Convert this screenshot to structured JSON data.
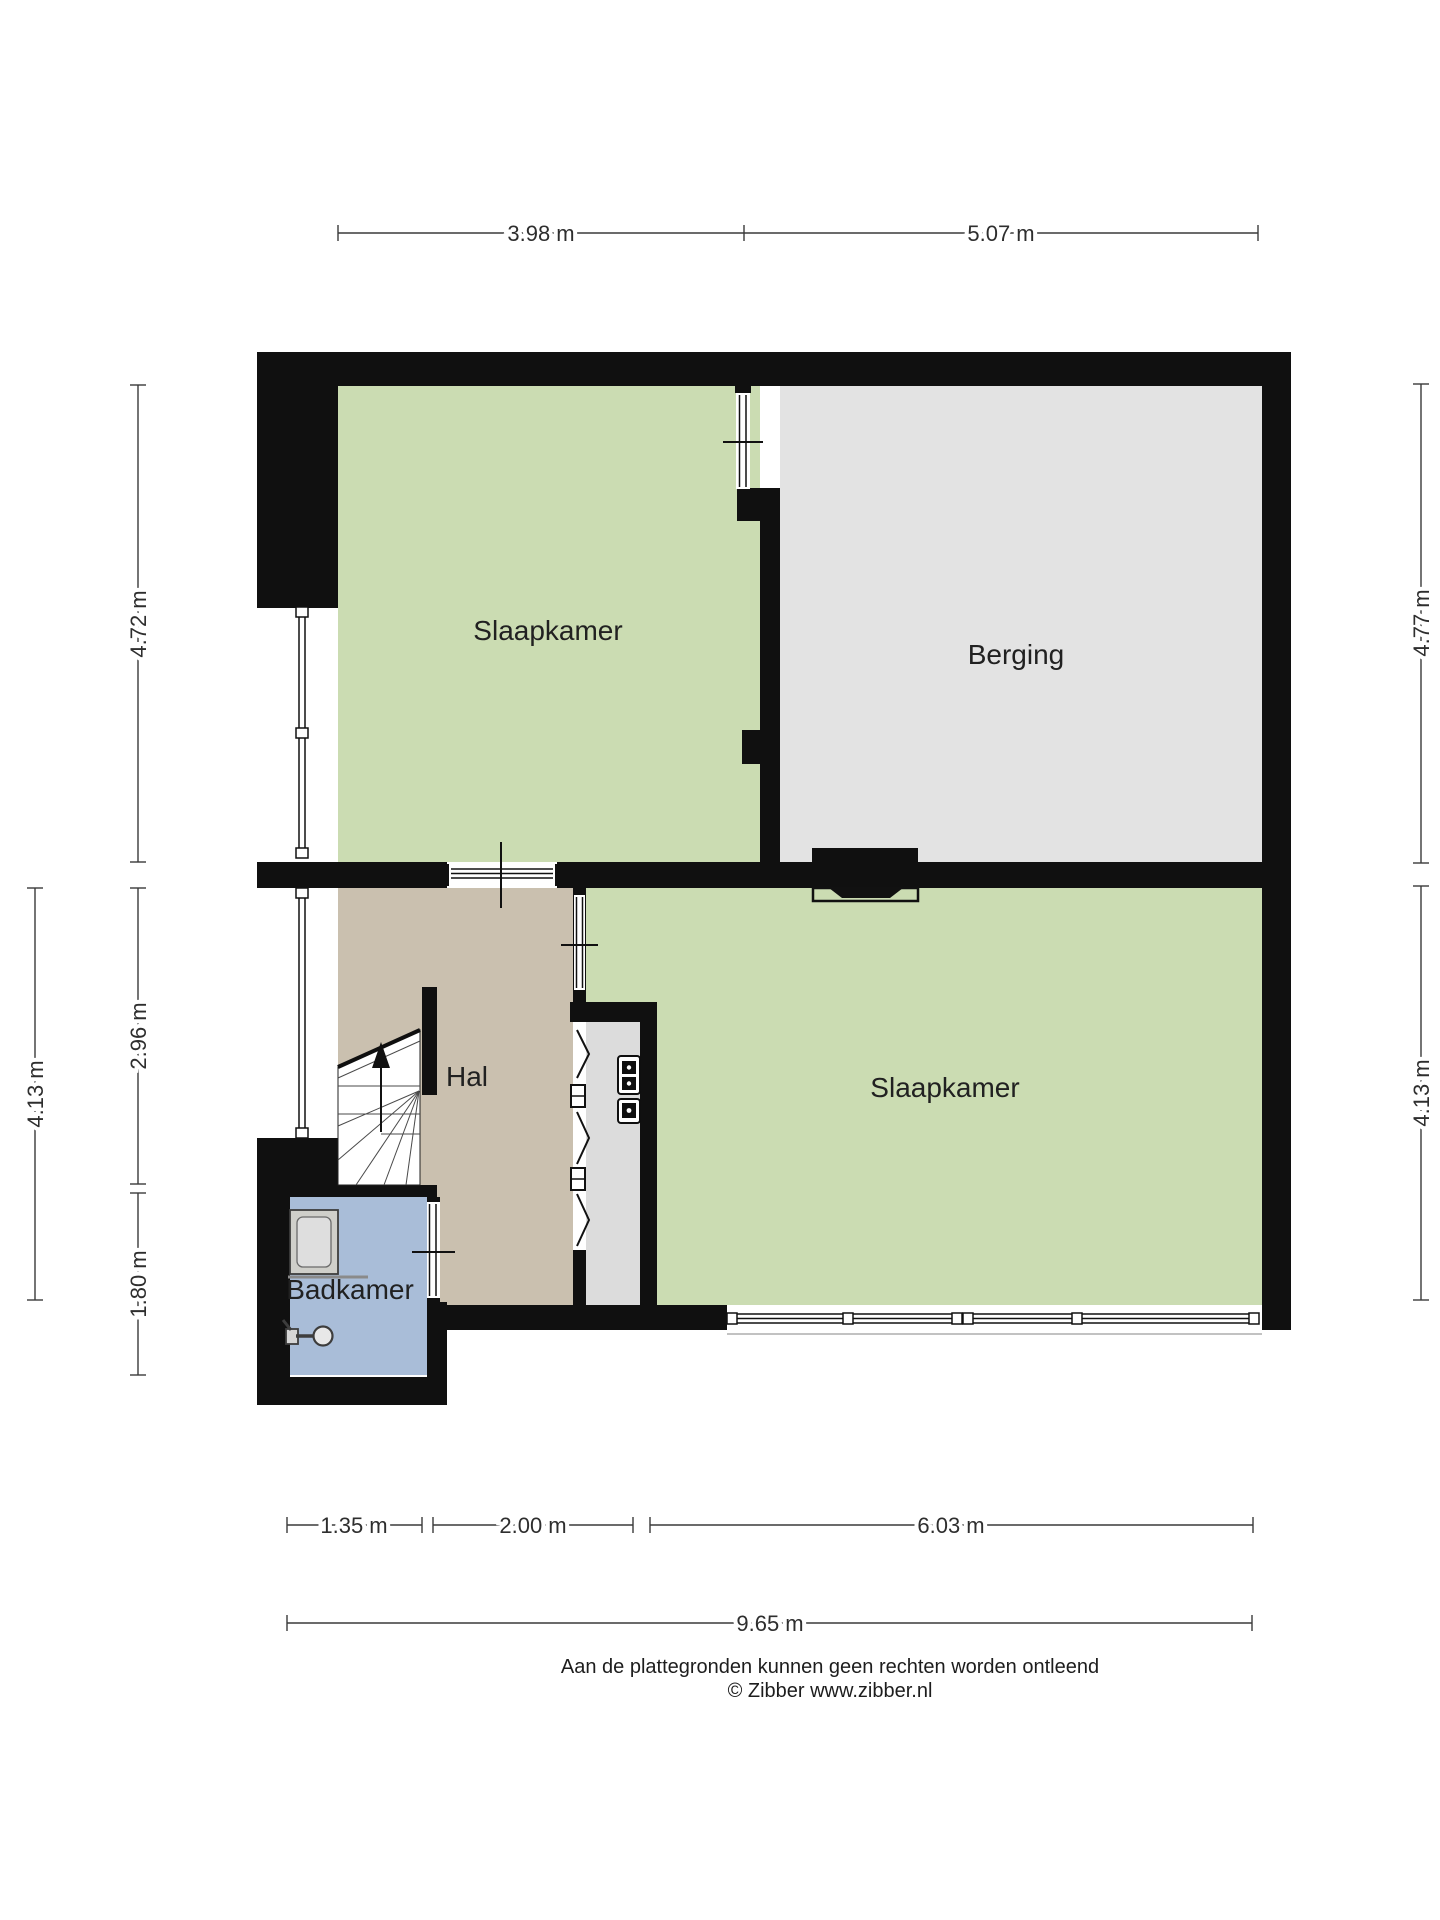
{
  "title": "Plattegrond verdieping",
  "rooms": {
    "slaapkamer_top": {
      "label": "Slaapkamer"
    },
    "berging": {
      "label": "Berging"
    },
    "slaapkamer_bottom": {
      "label": "Slaapkamer"
    },
    "hal": {
      "label": "Hal"
    },
    "badkamer": {
      "label": "Badkamer"
    }
  },
  "dimensions": {
    "top": {
      "left": "3.98 m",
      "right": "5.07 m"
    },
    "left_inner": {
      "top": "4.72 m",
      "middle": "2.96 m",
      "bottom": "1.80 m"
    },
    "left_outer": {
      "value": "4.13 m"
    },
    "right_side": {
      "top": "4.77 m",
      "bottom": "4.13 m"
    },
    "bottom": {
      "first": "1.35 m",
      "second": "2.00 m",
      "third": "6.03 m",
      "total": "9.65 m"
    }
  },
  "footer": {
    "disclaimer": "Aan de plattegronden kunnen geen rechten worden ontleend",
    "copyright": "© Zibber www.zibber.nl"
  },
  "icons": {
    "stairs_arrow": "up-arrow-icon",
    "meters": "meter-box-icon",
    "shower": "shower-tray-icon",
    "faucet": "faucet-icon",
    "folding_door": "folding-door-chevron-icon"
  },
  "colors": {
    "wall": "#101010",
    "room_green": "#cbdcb2",
    "berging_gray": "#e3e3e3",
    "hal_tan": "#cac0af",
    "badkamer_blue": "#a9bdd8",
    "closet_gray": "#dcdcdc",
    "dim_line": "#3a3a3a"
  }
}
